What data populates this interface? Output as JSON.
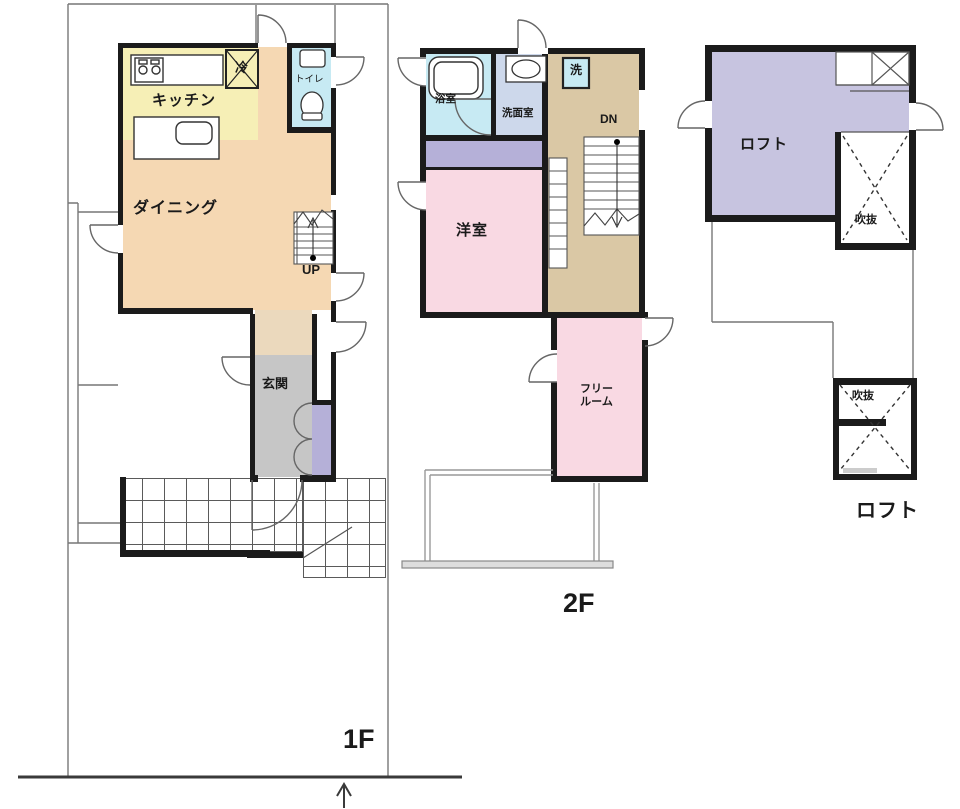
{
  "plan_title": "house-floor-plan",
  "colors": {
    "wall": "#1b1b1b",
    "thin_line": "#777777",
    "dining_peach": "#f5d8b3",
    "kitchen_yellow": "#f6efb6",
    "toilet_cyan": "#c7eaf3",
    "washroom_blue": "#cdd8eb",
    "hall_tan_1f": "#ebd9bd",
    "hall_tan_2f": "#dac8a5",
    "entrance_gray": "#c6c6c6",
    "closet_purple": "#b5b0d8",
    "room_pink": "#f9d9e3",
    "loft_lavender": "#c7c4e0"
  },
  "floor1": {
    "name": "1F",
    "kitchen": "キッチン",
    "fridge": "冷",
    "toilet": "トイレ",
    "dining": "ダイニング",
    "stairs_up": "UP",
    "entrance": "玄関"
  },
  "floor2": {
    "name": "2F",
    "bath": "浴室",
    "washroom": "洗面室",
    "washer": "洗",
    "stairs_down": "DN",
    "western_room": "洋室",
    "free_room_line1": "フリー",
    "free_room_line2": "ルーム"
  },
  "loft": {
    "room": "ロフト",
    "void_upper": "吹抜",
    "void_lower": "吹抜",
    "caption": "ロフト"
  }
}
